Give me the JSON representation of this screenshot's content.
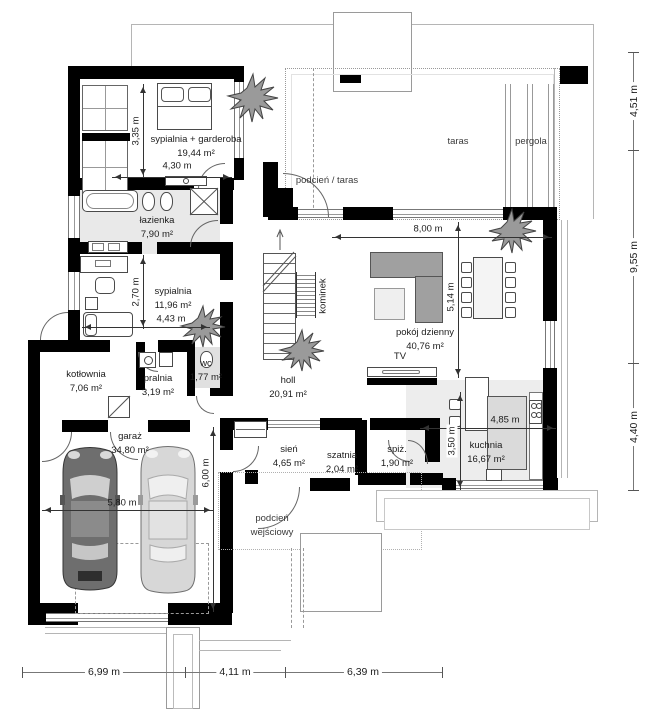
{
  "rooms": [
    {
      "name": "sypialnia + garderoba",
      "area": "19,44 m²"
    },
    {
      "name": "łazienka",
      "area": "7,90 m²"
    },
    {
      "name": "sypialnia",
      "area": "11,96 m²"
    },
    {
      "name": "kotłownia",
      "area": "7,06 m²"
    },
    {
      "name": "pralnia",
      "area": "3,19 m²"
    },
    {
      "name": "wc",
      "area": "1,77 m²"
    },
    {
      "name": "garaż",
      "area": "34,80 m²"
    },
    {
      "name": "holl",
      "area": "20,91 m²"
    },
    {
      "name": "sień",
      "area": "4,65 m²"
    },
    {
      "name": "szatnia",
      "area": "2,04 m²"
    },
    {
      "name": "spiż.",
      "area": "1,90 m²"
    },
    {
      "name": "kuchnia",
      "area": "16,67 m²"
    },
    {
      "name": "pokój dzienny",
      "area": "40,76 m²"
    }
  ],
  "zones": {
    "taras": "taras",
    "pergola": "pergola",
    "podcien_taras": "podcień / taras",
    "podcien_wejsciowy": "podcień wejściowy",
    "kominek": "kominek",
    "tv": "TV"
  },
  "dims": {
    "right": [
      "4,51 m",
      "9,55 m",
      "4,40 m"
    ],
    "bottom": [
      "6,99 m",
      "4,11 m",
      "6,39 m"
    ],
    "interior": {
      "h335": "3,35 m",
      "w430": "4,30 m",
      "h270": "2,70 m",
      "w443": "4,43 m",
      "w800": "8,00 m",
      "h514": "5,14 m",
      "w485": "4,85 m",
      "h350": "3,50 m",
      "h600": "6,00 m",
      "w580": "5,80 m"
    }
  },
  "colors": {
    "wall": "#000000",
    "floor_gray": "#e9e9e9",
    "sofa_gray": "#a0a0a0",
    "dim_text": "#1c1c1c"
  }
}
